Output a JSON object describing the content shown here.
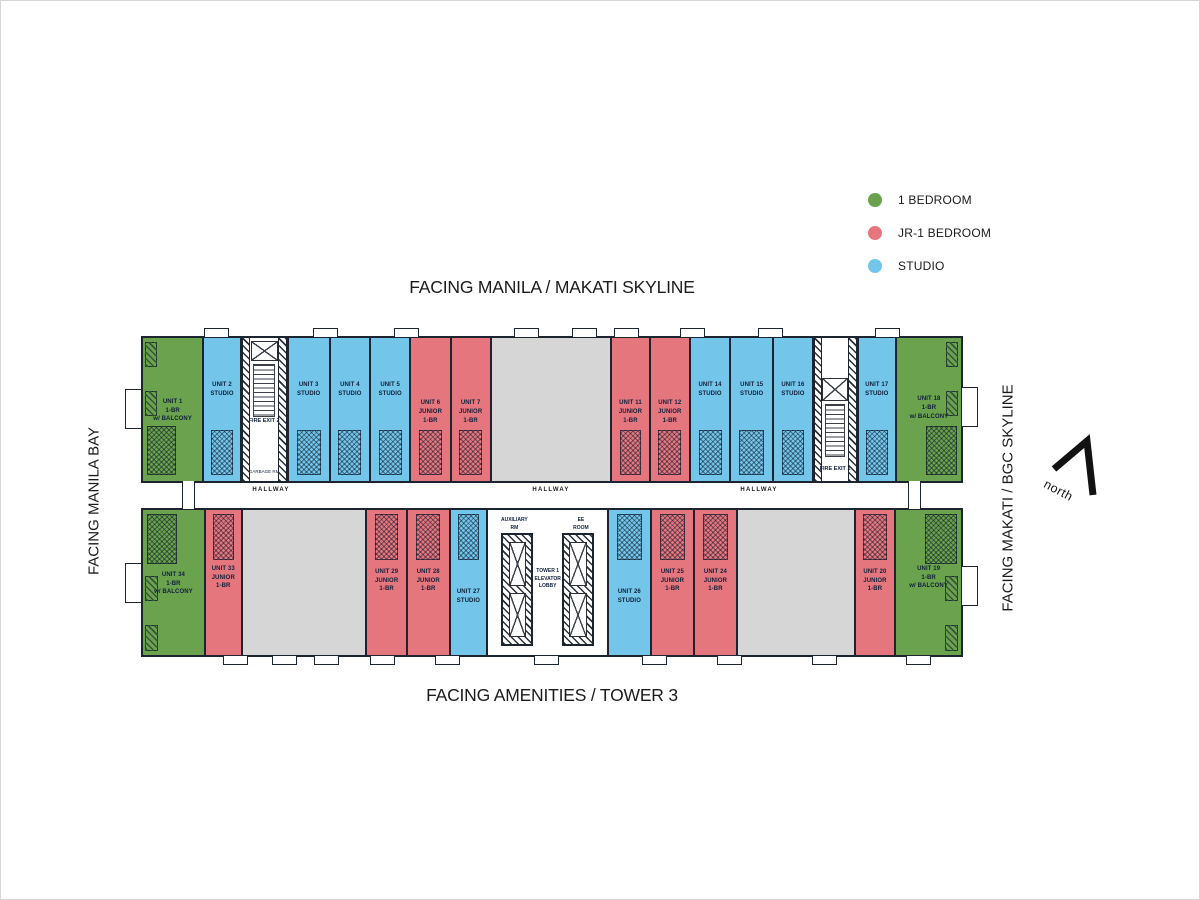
{
  "titles": {
    "top": "FACING MANILA / MAKATI SKYLINE",
    "bottom": "FACING AMENITIES / TOWER 3",
    "left": "FACING MANILA BAY",
    "right": "FACING MAKATI / BGC SKYLINE",
    "north": "north"
  },
  "legend": {
    "items": [
      {
        "label": "1 BEDROOM",
        "color": "#6aa24e"
      },
      {
        "label": "JR-1 BEDROOM",
        "color": "#e6767e"
      },
      {
        "label": "STUDIO",
        "color": "#73c6ea"
      }
    ]
  },
  "colors": {
    "one_bedroom": "#6aa24e",
    "jr_one_bedroom": "#e6767e",
    "studio": "#73c6ea",
    "unlabeled_gray": "#d6d6d6",
    "wall": "#1c2430"
  },
  "plan": {
    "hallway_labels": [
      "HALLWAY",
      "HALLWAY",
      "HALLWAY"
    ],
    "core": {
      "aux_lines": [
        "AUXILIARY",
        "RM"
      ],
      "ee_lines": [
        "EE",
        "ROOM"
      ],
      "lobby_lines": [
        "TOWER 1",
        "ELEVATOR",
        "LOBBY"
      ]
    },
    "top_wing": [
      {
        "id": "unit-1",
        "type": "1br",
        "corner": "left",
        "w": 62,
        "lab": 42,
        "lines": [
          "UNIT 1",
          "1-BR",
          "w/ BALCONY"
        ]
      },
      {
        "id": "unit-2",
        "type": "studio",
        "w": 37,
        "lab": 30,
        "lines": [
          "UNIT 2",
          "STUDIO"
        ]
      },
      {
        "id": "fire-exit-2",
        "type": "stair",
        "variant": "fe2",
        "w": 47,
        "lines": [
          "FIRE EXIT 2"
        ],
        "extra": "GARBAGE RM"
      },
      {
        "id": "unit-3",
        "type": "studio",
        "w": 42,
        "lab": 30,
        "lines": [
          "UNIT 3",
          "STUDIO"
        ]
      },
      {
        "id": "unit-4",
        "type": "studio",
        "w": 40,
        "lab": 30,
        "lines": [
          "UNIT 4",
          "STUDIO"
        ]
      },
      {
        "id": "unit-5",
        "type": "studio",
        "w": 40,
        "lab": 30,
        "lines": [
          "UNIT 5",
          "STUDIO"
        ]
      },
      {
        "id": "unit-6",
        "type": "jr1br",
        "w": 40,
        "lab": 43,
        "lines": [
          "UNIT 6",
          "JUNIOR",
          "1-BR"
        ]
      },
      {
        "id": "unit-7",
        "type": "jr1br",
        "w": 40,
        "lab": 43,
        "lines": [
          "UNIT 7",
          "JUNIOR",
          "1-BR"
        ]
      },
      {
        "id": "gray-block-top",
        "type": "gray",
        "w": 124,
        "lines": []
      },
      {
        "id": "unit-11",
        "type": "jr1br",
        "w": 38,
        "lab": 43,
        "lines": [
          "UNIT 11",
          "JUNIOR",
          "1-BR"
        ]
      },
      {
        "id": "unit-12",
        "type": "jr1br",
        "w": 40,
        "lab": 43,
        "lines": [
          "UNIT 12",
          "JUNIOR",
          "1-BR"
        ]
      },
      {
        "id": "unit-14",
        "type": "studio",
        "w": 40,
        "lab": 30,
        "lines": [
          "UNIT 14",
          "STUDIO"
        ]
      },
      {
        "id": "unit-15",
        "type": "studio",
        "w": 43,
        "lab": 30,
        "lines": [
          "UNIT 15",
          "STUDIO"
        ]
      },
      {
        "id": "unit-16",
        "type": "studio",
        "w": 39,
        "lab": 30,
        "lines": [
          "UNIT 16",
          "STUDIO"
        ]
      },
      {
        "id": "fire-exit-1",
        "type": "stair",
        "variant": "fe1",
        "w": 45,
        "lines": [
          "FIRE EXIT 1"
        ]
      },
      {
        "id": "unit-17",
        "type": "studio",
        "w": 38,
        "lab": 30,
        "lines": [
          "UNIT 17",
          "STUDIO"
        ]
      },
      {
        "id": "unit-18",
        "type": "1br",
        "corner": "right",
        "w": 67,
        "lab": 40,
        "lines": [
          "UNIT 18",
          "1-BR",
          "w/ BALCONY"
        ]
      }
    ],
    "bottom_wing": [
      {
        "id": "unit-34",
        "type": "1br",
        "corner": "left",
        "w": 63,
        "lab": 42,
        "lines": [
          "UNIT 34",
          "1-BR",
          "w/ BALCONY"
        ]
      },
      {
        "id": "unit-33",
        "type": "jr1br",
        "w": 36,
        "lab": 38,
        "lines": [
          "UNIT 33",
          "JUNIOR",
          "1-BR"
        ]
      },
      {
        "id": "gray-block-bottom-left",
        "type": "gray",
        "w": 127,
        "lines": []
      },
      {
        "id": "unit-29",
        "type": "jr1br",
        "w": 40,
        "lab": 40,
        "lines": [
          "UNIT 29",
          "JUNIOR",
          "1-BR"
        ]
      },
      {
        "id": "unit-28",
        "type": "jr1br",
        "w": 42,
        "lab": 40,
        "lines": [
          "UNIT 28",
          "JUNIOR",
          "1-BR"
        ]
      },
      {
        "id": "unit-27",
        "type": "studio",
        "w": 37,
        "lab": 54,
        "lines": [
          "UNIT 27",
          "STUDIO"
        ]
      },
      {
        "id": "tower-1-core",
        "type": "core",
        "w": 123,
        "lines": []
      },
      {
        "id": "unit-26",
        "type": "studio",
        "w": 42,
        "lab": 54,
        "lines": [
          "UNIT 26",
          "STUDIO"
        ]
      },
      {
        "id": "unit-25",
        "type": "jr1br",
        "w": 43,
        "lab": 40,
        "lines": [
          "UNIT 25",
          "JUNIOR",
          "1-BR"
        ]
      },
      {
        "id": "unit-24",
        "type": "jr1br",
        "w": 42,
        "lab": 40,
        "lines": [
          "UNIT 24",
          "JUNIOR",
          "1-BR"
        ]
      },
      {
        "id": "gray-block-bottom-right",
        "type": "gray",
        "w": 120,
        "lines": []
      },
      {
        "id": "unit-20",
        "type": "jr1br",
        "w": 40,
        "lab": 40,
        "lines": [
          "UNIT 20",
          "JUNIOR",
          "1-BR"
        ]
      },
      {
        "id": "unit-19",
        "type": "1br",
        "corner": "right",
        "w": 67,
        "lab": 38,
        "lines": [
          "UNIT 19",
          "1-BR",
          "w/ BALCONY"
        ]
      }
    ]
  }
}
